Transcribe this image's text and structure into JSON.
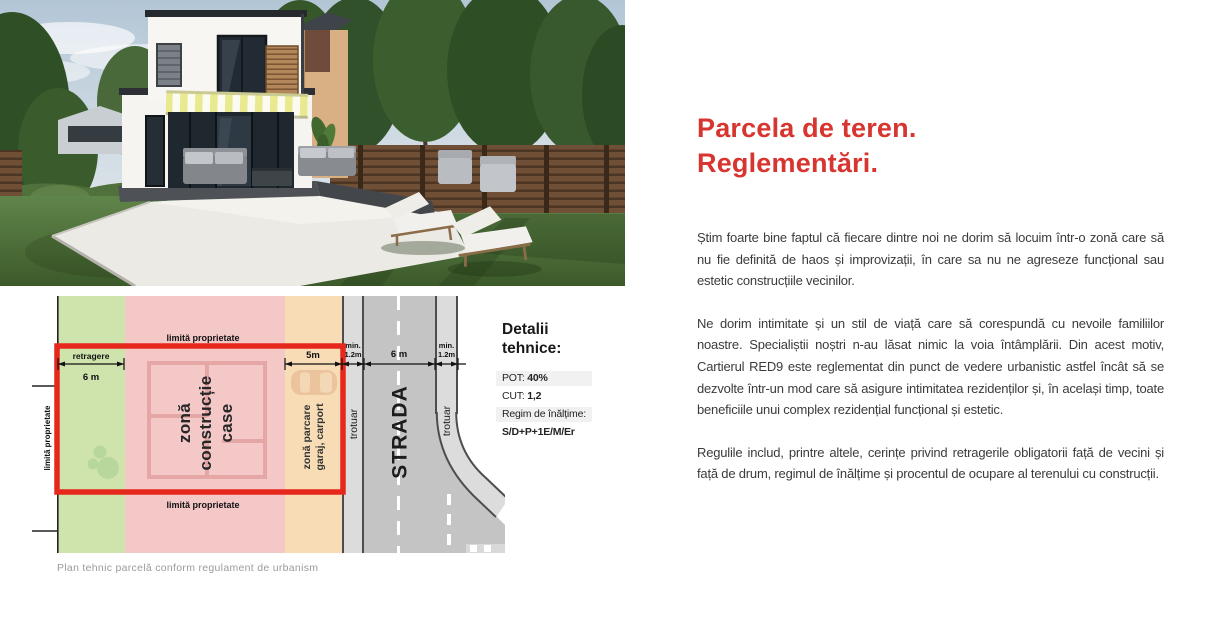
{
  "article": {
    "title": [
      "Parcela de teren.",
      "Reglementări."
    ],
    "p1": "Știm foarte bine faptul că fiecare dintre noi ne dorim să locuim într-o zonă care să nu fie definită de haos și improvizații, în care sa nu ne agreseze funcțional sau estetic construcțiile vecinilor.",
    "p2": "Ne dorim intimitate și un stil de viață care să corespundă cu nevoile familiilor noastre. Specialiștii noștri n-au lăsat nimic la voia întâmplării. Din acest motiv, Cartierul RED9 este reglementat din punct de vedere urbanistic astfel încât să se dezvolte într-un mod care să asigure intimitatea rezidenților și, în același timp, toate beneficiile unui complex rezidențial funcțional și estetic.",
    "p3": "Regulile includ, printre altele, cerințe privind retragerile obligatorii față de vecini și față de drum, regimul de înălțime și procentul de ocupare al terenului cu construcții."
  },
  "tech": {
    "title": [
      "Detalii",
      "tehnice:"
    ],
    "pot_label": "POT:",
    "pot_value": "40%",
    "cut_label": "CUT:",
    "cut_value": "1,2",
    "regim_label": "Regim de înălțime:",
    "regim_value": "S/D+P+1E/M/Er"
  },
  "diagram": {
    "boundary_top": "limită proprietate",
    "boundary_bottom": "limită proprietate",
    "boundary_left": "limită proprietate",
    "retragere_label": "retragere",
    "retragere_value": "6 m",
    "parking_width": "5m",
    "min_width": [
      "min.",
      "1.2m"
    ],
    "street_width": "6 m",
    "zone_construction": [
      "zonă",
      "construcție",
      "case"
    ],
    "zone_parking": [
      "zonă parcare",
      "garaj, carport"
    ],
    "sidewalk_label": "trotuar",
    "street_label": "STRADA",
    "caption": "Plan tehnic parcelă conform regulament de urbanism"
  },
  "colors": {
    "accent": "#d7352f",
    "plot_border": "#e6281c",
    "zone_green": "#cfe3ad",
    "zone_pink": "#f5c8c8",
    "zone_orange": "#f7dcb6",
    "sidewalk": "#dcdcdc",
    "road": "#c4c4c4"
  }
}
